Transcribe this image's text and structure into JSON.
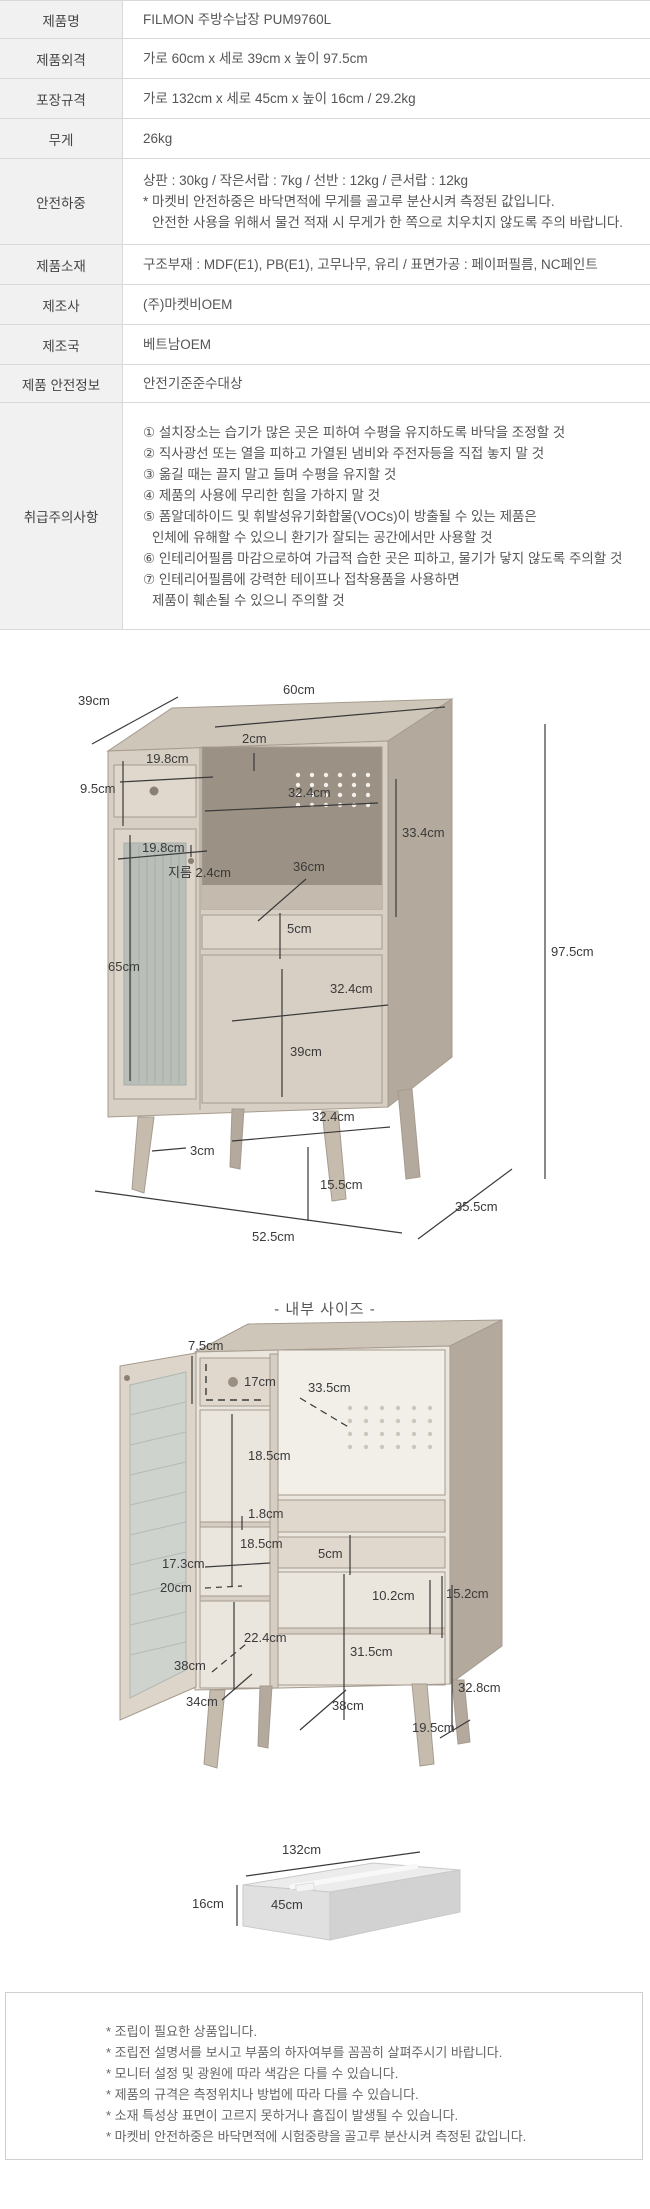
{
  "spec_table": {
    "rows": [
      {
        "label": "제품명",
        "value": "FILMON 주방수납장 PUM9760L"
      },
      {
        "label": "제품외격",
        "value": "가로 60cm x 세로 39cm x 높이 97.5cm"
      },
      {
        "label": "포장규격",
        "value": "가로 132cm x 세로 45cm x 높이 16cm / 29.2kg"
      },
      {
        "label": "무게",
        "value": "26kg"
      },
      {
        "label": "안전하중",
        "value_lines": [
          "상판 : 30kg / 작은서랍 : 7kg / 선반 : 12kg / 큰서랍 : 12kg",
          "* 마켓비 안전하중은 바닥면적에 무게를 골고루 분산시켜 측정된 값입니다.",
          "안전한 사용을 위해서 물건 적재 시 무게가 한 쪽으로 치우치지 않도록 주의 바랍니다."
        ]
      },
      {
        "label": "제품소재",
        "value": "구조부재 : MDF(E1), PB(E1), 고무나무, 유리 / 표면가공 : 페이퍼필름, NC페인트"
      },
      {
        "label": "제조사",
        "value": "(주)마켓비OEM"
      },
      {
        "label": "제조국",
        "value": "베트남OEM"
      },
      {
        "label": "제품 안전정보",
        "value": "안전기준준수대상"
      },
      {
        "label": "취급주의사항",
        "value_lines": [
          "① 설치장소는 습기가 많은 곳은 피하여 수평을 유지하도록 바닥을 조정할 것",
          "② 직사광선 또는 열을 피하고 가열된 냄비와 주전자등을 직접 놓지 말 것",
          "③ 옮길 때는 끌지 말고 들며 수평을 유지할 것",
          "④ 제품의 사용에 무리한 힘을 가하지 말 것",
          "⑤ 폼알데하이드 및 휘발성유기화합물(VOCs)이 방출될 수 있는 제품은",
          "인체에 유해할 수 있으니 환기가 잘되는 공간에서만 사용할 것",
          "⑥ 인테리어필름 마감으로하여 가급적 습한 곳은 피하고, 물기가 닿지 않도록 주의할 것",
          "⑦ 인테리어필름에 강력한 테이프나 접착용품을 사용하면",
          "제품이 훼손될 수 있으니 주의할 것"
        ]
      }
    ]
  },
  "external_diagram": {
    "dims": {
      "depth": "39cm",
      "width": "60cm",
      "top_thickness": "2cm",
      "small_drawer_width": "19.8cm",
      "small_drawer_height": "9.5cm",
      "open_width": "32.4cm",
      "open_height": "33.4cm",
      "glass_door_width": "19.8cm",
      "knob_diameter": "지름 2.4cm",
      "shelf_depth": "36cm",
      "drawer_front_height": "5cm",
      "glass_door_height": "65cm",
      "door_width_top": "32.4cm",
      "door_height": "39cm",
      "door_width_bottom": "32.4cm",
      "leg_thickness": "3cm",
      "leg_height": "15.5cm",
      "bottom_width": "52.5cm",
      "bottom_depth": "35.5cm",
      "total_height": "97.5cm"
    }
  },
  "internal_diagram": {
    "title": "- 내부 사이즈 -",
    "dims": {
      "drawer_inner_height": "7.5cm",
      "drawer_inner_width": "17cm",
      "inner_depth": "33.5cm",
      "upper_compartment_height": "18.5cm",
      "panel_thickness": "1.8cm",
      "mid_compartment_height": "18.5cm",
      "left_inner_width": "17.3cm",
      "left_depth": "20cm",
      "drawer_front_inner": "5cm",
      "drawer_inner_depth": "10.2cm",
      "right_upper_height": "15.2cm",
      "lower_compartment_height": "22.4cm",
      "right_lower_height": "31.5cm",
      "door_inner_depth": "38cm",
      "left_bottom_height": "34cm",
      "bottom_inner_width": "38cm",
      "right_inner_height": "32.8cm",
      "bottom_inner_depth": "19.5cm"
    }
  },
  "package_diagram": {
    "dims": {
      "width": "132cm",
      "height": "16cm",
      "depth": "45cm"
    }
  },
  "footer_notes": [
    "* 조립이 필요한 상품입니다.",
    "* 조립전 설명서를 보시고 부품의 하자여부를 꼼꼼히 살펴주시기 바랍니다.",
    "* 모니터 설정 및 광원에 따라 색감은 다를 수 있습니다.",
    "* 제품의 규격은 측정위치나 방법에 따라 다를 수 있습니다.",
    "* 소재 특성상 표면이 고르지 못하거나 흠집이 발생될 수 있습니다.",
    "* 마켓비 안전하중은 바닥면적에 시험중량을 골고루 분산시켜 측정된 값입니다."
  ]
}
